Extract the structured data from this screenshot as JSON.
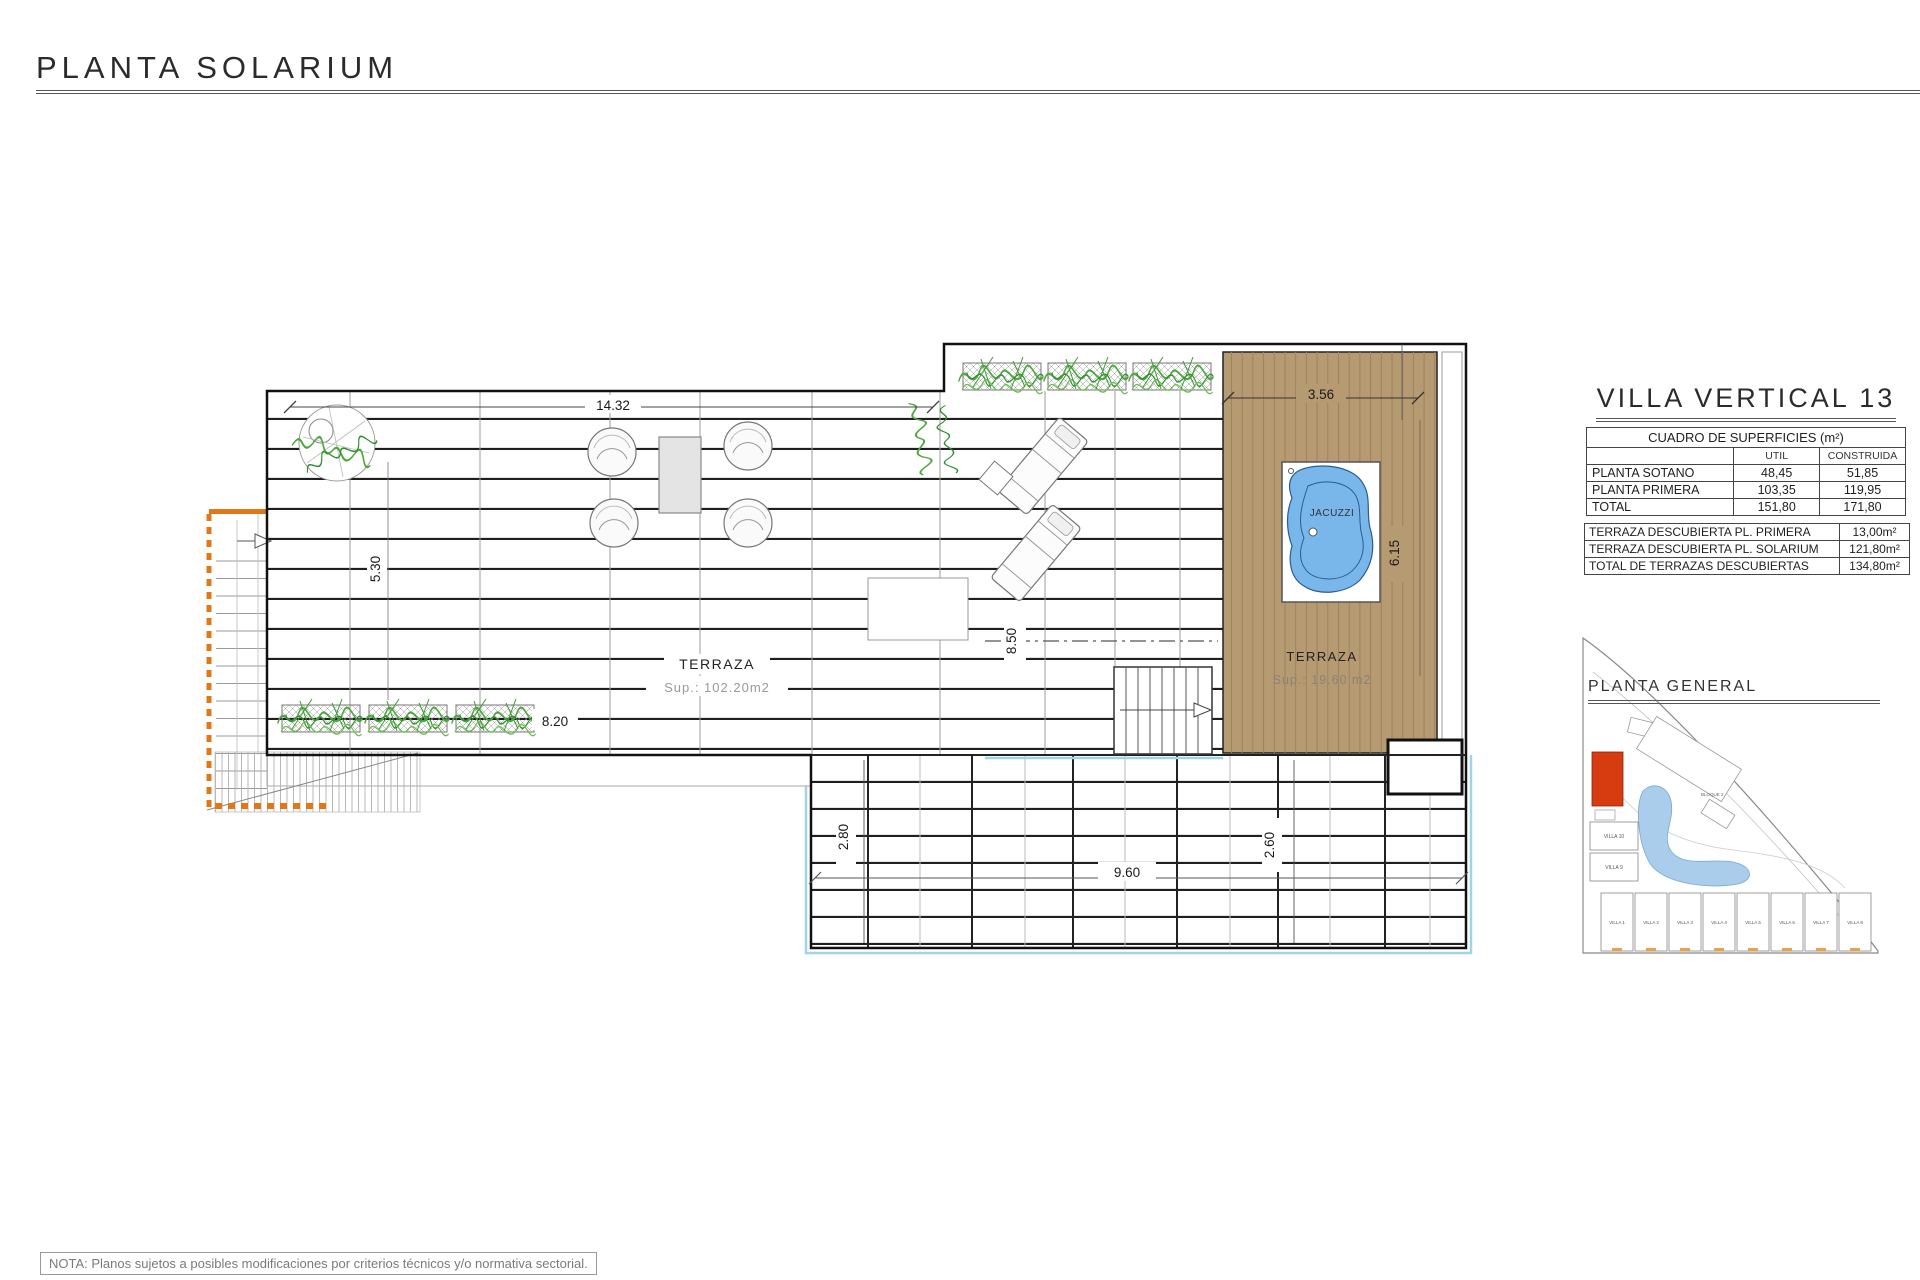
{
  "page": {
    "title": "PLANTA SOLARIUM",
    "note": "NOTA: Planos sujetos a posibles modificaciones por criterios técnicos y/o normativa sectorial."
  },
  "panel": {
    "title": "VILLA VERTICAL 13",
    "surfaces": {
      "title": "CUADRO DE SUPERFICIES (m²)",
      "columns": {
        "util": "UTIL",
        "construida": "CONSTRUIDA"
      },
      "rows": [
        {
          "label": "PLANTA SOTANO",
          "util": "48,45",
          "construida": "51,85"
        },
        {
          "label": "PLANTA PRIMERA",
          "util": "103,35",
          "construida": "119,95"
        },
        {
          "label": "TOTAL",
          "util": "151,80",
          "construida": "171,80"
        }
      ]
    },
    "terraces": {
      "rows": [
        {
          "label": "TERRAZA DESCUBIERTA PL. PRIMERA",
          "value": "13,00m²"
        },
        {
          "label": "TERRAZA DESCUBIERTA PL. SOLARIUM",
          "value": "121,80m²"
        },
        {
          "label": "TOTAL DE TERRAZAS DESCUBIERTAS",
          "value": "134,80m²"
        }
      ]
    },
    "siteplan": {
      "label": "PLANTA GENERAL",
      "bloque": "BLOQUE 2",
      "left_villas": [
        "VILLA 10",
        "VILLA 9"
      ],
      "bottom_villas": [
        "VILLA 1",
        "VILLA 2",
        "VILLA 3",
        "VILLA 4",
        "VILLA 5",
        "VILLA 6",
        "VILLA 7",
        "VILLA 8"
      ]
    }
  },
  "plan": {
    "main_terrace": {
      "label": "TERRAZA",
      "area": "Sup.: 102.20m2"
    },
    "deck_terrace": {
      "label": "TERRAZA",
      "area": "Sup.: 19.60  m2"
    },
    "jacuzzi": "JACUZZI",
    "dims": {
      "top_width": "14.32",
      "deck_width": "3.56",
      "left_height": "5.30",
      "deck_height": "6.15",
      "planter_width": "8.20",
      "center_height": "8.50",
      "lower_left_height": "2.80",
      "lower_width": "9.60",
      "lower_right_height": "2.60"
    }
  },
  "colors": {
    "deck_wood": "#b69a72",
    "deck_line": "#9b835e",
    "jacuzzi_blue": "#79b7ea",
    "plant_green": "#55a944",
    "stair_orange": "#e07818",
    "site_red": "#d63c10",
    "site_water": "#a9cdeb",
    "pool_edge_cyan": "#9fd4e6"
  }
}
